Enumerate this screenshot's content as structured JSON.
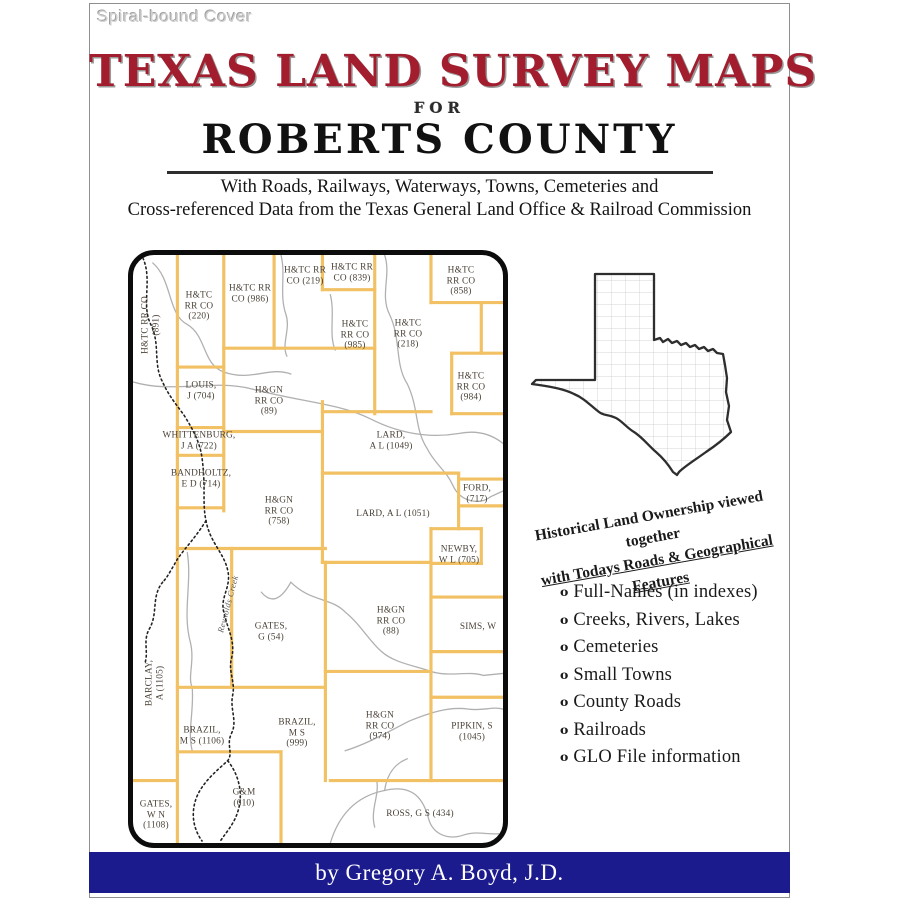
{
  "page": {
    "cover_note": "Spiral-bound Cover",
    "title": "TEXAS LAND SURVEY MAPS",
    "for_word": "FOR",
    "county": "ROBERTS COUNTY",
    "subtitle_line1": "With Roads, Railways, Waterways, Towns, Cemeteries and",
    "subtitle_line2": "Cross-referenced Data from the Texas General Land Office & Railroad Commission",
    "footer": "by Gregory A. Boyd, J.D.",
    "colors": {
      "title_red": "#A21E2E",
      "footer_bar_blue": "#1B1B8E",
      "survey_line_orange": "#F1C163",
      "creek_black": "#222222",
      "road_gray": "#b0b0b0"
    }
  },
  "promo": {
    "tagline_line1": "Historical Land Ownership viewed together",
    "tagline_line2": "with Todays Roads & Geographical Features",
    "bullet_glyph": "o",
    "features": [
      "Full-Names (in indexes)",
      "Creeks, Rivers, Lakes",
      "Cemeteries",
      "Small Towns",
      "County Roads",
      "Railroads",
      "GLO File information"
    ]
  },
  "map": {
    "labels": [
      {
        "lines": [
          "H&TC RR CO",
          "(891)"
        ],
        "x": 18,
        "y": 70,
        "rot": true
      },
      {
        "lines": [
          "H&TC",
          "RR CO",
          "(220)"
        ],
        "x": 66,
        "y": 51
      },
      {
        "lines": [
          "H&TC RR",
          "CO (986)"
        ],
        "x": 117,
        "y": 39
      },
      {
        "lines": [
          "H&TC RR",
          "CO (219)"
        ],
        "x": 172,
        "y": 21
      },
      {
        "lines": [
          "H&TC RR",
          "CO (839)"
        ],
        "x": 219,
        "y": 18
      },
      {
        "lines": [
          "H&TC",
          "RR CO",
          "(858)"
        ],
        "x": 328,
        "y": 26
      },
      {
        "lines": [
          "H&TC",
          "RR CO",
          "(985)"
        ],
        "x": 222,
        "y": 80
      },
      {
        "lines": [
          "H&TC",
          "RR CO",
          "(218)"
        ],
        "x": 275,
        "y": 79
      },
      {
        "lines": [
          "H&TC",
          "RR CO",
          "(984)"
        ],
        "x": 338,
        "y": 132
      },
      {
        "lines": [
          "LOUIS,",
          "J (704)"
        ],
        "x": 68,
        "y": 136
      },
      {
        "lines": [
          "H&GN",
          "RR CO",
          "(89)"
        ],
        "x": 136,
        "y": 146
      },
      {
        "lines": [
          "WHITTENBURG,",
          "J A (722)"
        ],
        "x": 66,
        "y": 186
      },
      {
        "lines": [
          "BANDHOLTZ,",
          "E D (714)"
        ],
        "x": 68,
        "y": 224
      },
      {
        "lines": [
          "H&GN",
          "RR CO",
          "(758)"
        ],
        "x": 146,
        "y": 256
      },
      {
        "lines": [
          "LARD,",
          "A L (1049)"
        ],
        "x": 258,
        "y": 186
      },
      {
        "lines": [
          "LARD, A L (1051)"
        ],
        "x": 260,
        "y": 259
      },
      {
        "lines": [
          "FORD,",
          "(717)"
        ],
        "x": 344,
        "y": 239
      },
      {
        "lines": [
          "NEWBY,",
          "W L (705)"
        ],
        "x": 326,
        "y": 300
      },
      {
        "lines": [
          "GATES,",
          "G (54)"
        ],
        "x": 138,
        "y": 377
      },
      {
        "lines": [
          "BARCLAY,",
          "A (1105)"
        ],
        "x": 22,
        "y": 428,
        "rot": true
      },
      {
        "lines": [
          "Reynolds Creek"
        ],
        "x": 95,
        "y": 349,
        "creek": true
      },
      {
        "lines": [
          "SIMS, W"
        ],
        "x": 345,
        "y": 372
      },
      {
        "lines": [
          "H&GN",
          "RR CO",
          "(88)"
        ],
        "x": 258,
        "y": 366
      },
      {
        "lines": [
          "BRAZIL,",
          "M S (1106)"
        ],
        "x": 69,
        "y": 481
      },
      {
        "lines": [
          "BRAZIL,",
          "M S",
          "(999)"
        ],
        "x": 164,
        "y": 478
      },
      {
        "lines": [
          "H&GN",
          "RR CO",
          "(974)"
        ],
        "x": 247,
        "y": 471
      },
      {
        "lines": [
          "PIPKIN, S",
          "(1045)"
        ],
        "x": 339,
        "y": 477
      },
      {
        "lines": [
          "G&M",
          "(610)"
        ],
        "x": 111,
        "y": 543
      },
      {
        "lines": [
          "GATES,",
          "W N",
          "(1108)"
        ],
        "x": 23,
        "y": 560
      },
      {
        "lines": [
          "ROSS, G S (434)"
        ],
        "x": 287,
        "y": 559
      }
    ]
  }
}
